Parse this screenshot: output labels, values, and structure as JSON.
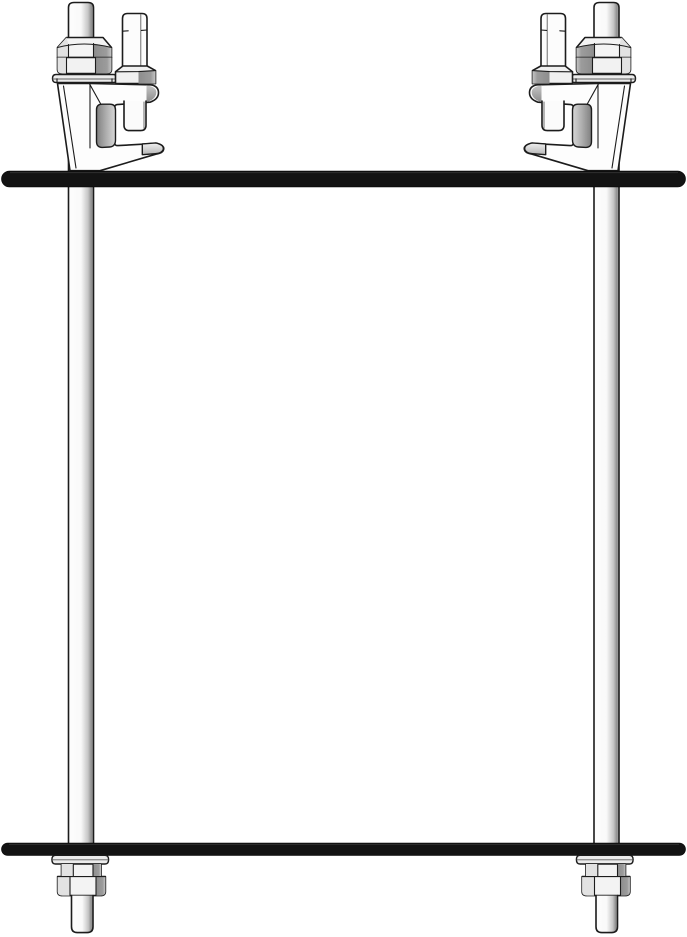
{
  "diagram": {
    "type": "isometric-assembly-drawing",
    "description": "Trapeze hanger assembly detail: two C-type beam clamps with set screws gripping an upper support bar, twin vertical threaded rods, and a lower support bar fastened beneath with washers and hex nuts",
    "canvas": {
      "width": 687,
      "height": 937,
      "background": "#ffffff"
    },
    "colors": {
      "outline": "#1c1c1c",
      "bar_fill": "#131313",
      "bar_highlight": "#3c3c3c",
      "metal_white": "#fdfdfd",
      "metal_light": "#ececec",
      "metal_mid": "#c6c6c6",
      "metal_dark": "#8d8d8d",
      "facet_light": "#e2e2e2",
      "detail_line": "#5f5f5f",
      "background": "#ffffff"
    },
    "components": [
      {
        "id": "beam-clamp-top-left",
        "label": "beam clamp with set screw"
      },
      {
        "id": "beam-clamp-top-right",
        "label": "beam clamp with set screw (mirrored)"
      },
      {
        "id": "upper-support-bar",
        "label": "upper support bar"
      },
      {
        "id": "lower-support-bar",
        "label": "lower support bar"
      },
      {
        "id": "threaded-rod-left",
        "label": "threaded rod"
      },
      {
        "id": "threaded-rod-right",
        "label": "threaded rod"
      },
      {
        "id": "fastener-bottom-left",
        "label": "washer and hex nut"
      },
      {
        "id": "fastener-bottom-right",
        "label": "washer and hex nut"
      }
    ]
  }
}
